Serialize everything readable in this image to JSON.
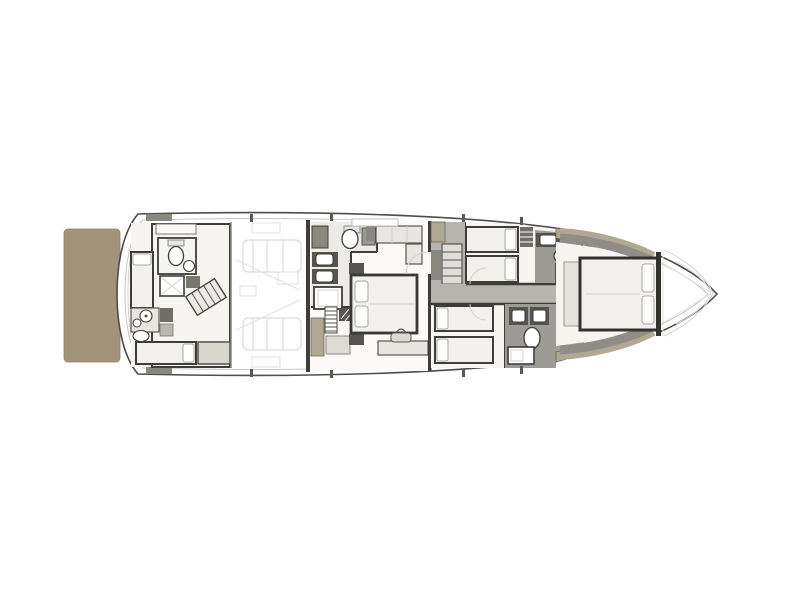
{
  "scene": {
    "type": "yacht-lower-deck-floor-plan",
    "orientation": "bow-right-stern-left",
    "visible_text": []
  },
  "colors": {
    "background": "#ffffff",
    "hull_outline": "#4e4d4b",
    "inner_line": "#c9c7c3",
    "wall_dark": "#3e3d3a",
    "platform_tan": "#a29478",
    "cabinet_tan": "#b1a894",
    "floor_light": "#f6f5f2",
    "floor_gray": "#b7b4af",
    "bath_gray": "#9d9b95",
    "furniture_light": "#f3f1ee",
    "furniture_mid": "#e9e6e1",
    "fixture_white": "#ffffff",
    "counter_dark": "#55544e",
    "lounger_gray": "#8f8d85",
    "faint": "#d5d3cf"
  }
}
